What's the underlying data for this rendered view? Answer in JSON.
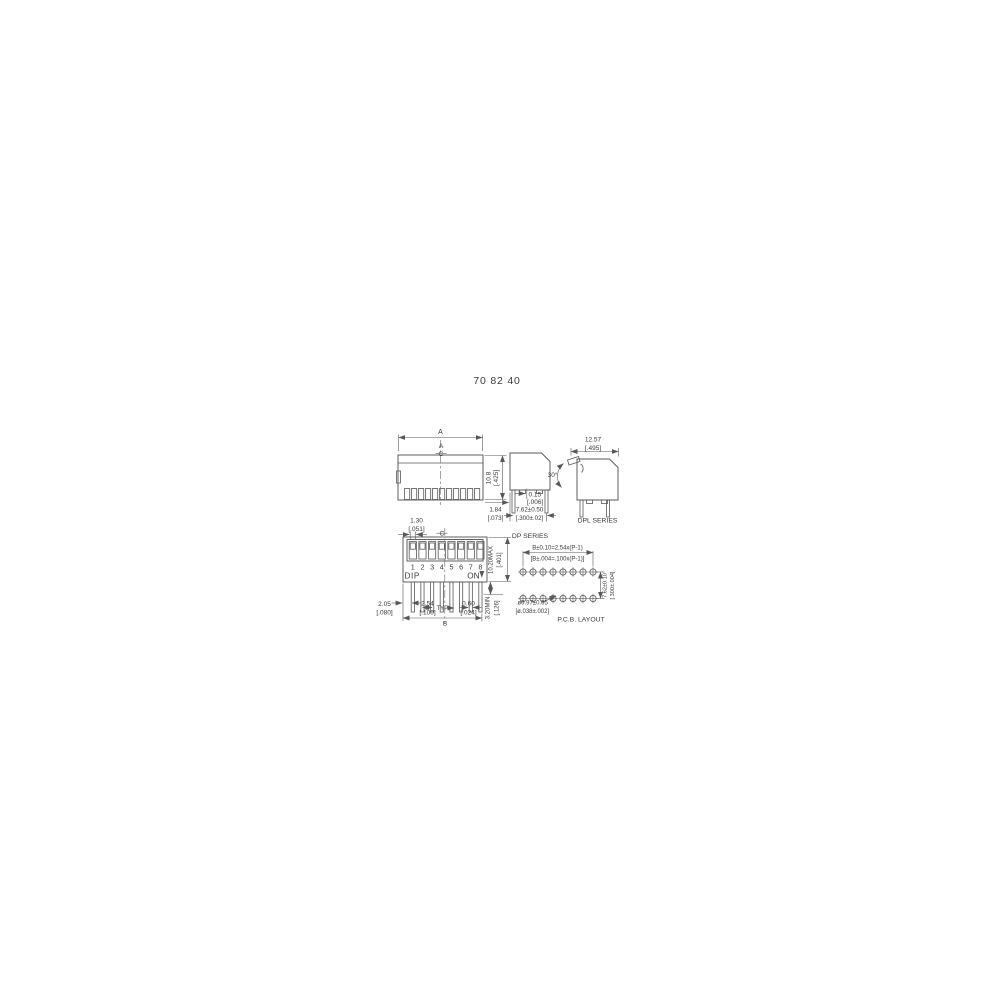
{
  "title": "70 82 40",
  "colors": {
    "background": "#ffffff",
    "line": "#585858",
    "text": "#3a3a3a"
  },
  "drawings": {
    "side_view": {
      "dim_a_top": "A",
      "dim_a_inner": "A",
      "centerline_symbol": "C",
      "height_mm": "10.8",
      "height_in": "[.425]"
    },
    "dp_series": {
      "label": "DP SERIES",
      "pin_offset_mm": "1.84",
      "pin_offset_in": "[.073]",
      "pin_spacing_mm": "7.62±0.50",
      "pin_spacing_in": "[.300±.02]",
      "standoff_mm": "0.15",
      "standoff_in": "[.006]",
      "actuator_angle": "30°"
    },
    "dpl_series": {
      "label": "DPL SERIES",
      "width_mm": "12.57",
      "width_in": "[.495]"
    },
    "top_view": {
      "positions": [
        "1",
        "2",
        "3",
        "4",
        "5",
        "6",
        "7",
        "8"
      ],
      "dip_label": "DIP",
      "on_label": "ON",
      "centerline_symbol": "C",
      "actuator_width_mm": "1.30",
      "actuator_width_in": "[.051]",
      "body_width_mm": "10.20MAX",
      "body_width_in": "[.401]",
      "pin_length_mm": "3.20MIN",
      "pin_length_in": "[.126]",
      "end_offset_mm": "2.05",
      "end_offset_in": "[.080]",
      "pitch_mm": "2.54",
      "pitch_in": "[.100]",
      "pitch_qualifier": "TYP",
      "pin_width_mm": "0.60",
      "pin_width_in": "[.024]",
      "span_label": "B"
    },
    "pcb_layout": {
      "label": "P.C.B. LAYOUT",
      "span_formula_mm": "B±0.10=2.54x(P-1)",
      "span_formula_in": "[B±.004=.100x(P-1)]",
      "row_spacing_mm": "7.62±0.10",
      "row_spacing_in": "[.300±.004]",
      "hole_dia_mm": "ø0.97±0.05",
      "hole_dia_in": "[ø.038±.002]"
    }
  }
}
